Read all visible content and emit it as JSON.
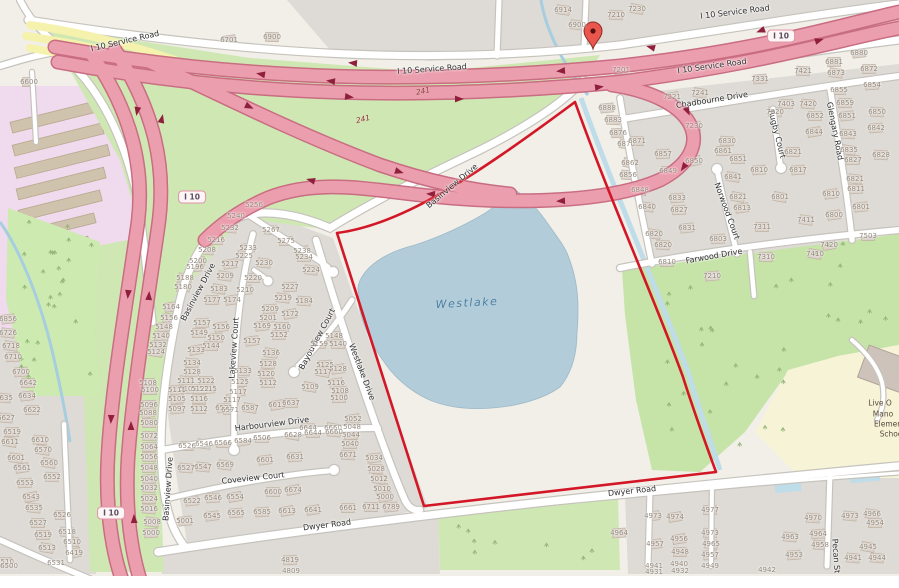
{
  "poi": {
    "lake_name": "Westlake",
    "school_lines": [
      "Live O",
      "Mano",
      "Elemen",
      "Schoo"
    ]
  },
  "marker": {
    "x": 593,
    "y": 33
  },
  "route_shields": [
    {
      "label": "I 10",
      "x": 192,
      "y": 197
    },
    {
      "label": "I 10",
      "x": 111,
      "y": 513
    },
    {
      "label": "I 10",
      "x": 781,
      "y": 36
    }
  ],
  "exit_numbers": [
    {
      "label": "241",
      "x": 423,
      "y": 91,
      "rot": -12
    },
    {
      "label": "241",
      "x": 363,
      "y": 119,
      "rot": -14
    }
  ],
  "street_labels": [
    {
      "t": "I 10 Service Road",
      "x": 125,
      "y": 41,
      "r": -13
    },
    {
      "t": "I 10 Service Road",
      "x": 432,
      "y": 69,
      "r": -4
    },
    {
      "t": "I 10 Service Road",
      "x": 735,
      "y": 12,
      "r": -7
    },
    {
      "t": "I 10 Service Road",
      "x": 712,
      "y": 66,
      "r": -8
    },
    {
      "t": "Basinview Drive",
      "x": 452,
      "y": 186,
      "r": -40
    },
    {
      "t": "Basinview Drive",
      "x": 198,
      "y": 292,
      "r": -62
    },
    {
      "t": "Basinview Drive",
      "x": 168,
      "y": 489,
      "r": -86
    },
    {
      "t": "Lakeview Court",
      "x": 234,
      "y": 348,
      "r": -86
    },
    {
      "t": "Bayouview Court",
      "x": 317,
      "y": 339,
      "r": -62
    },
    {
      "t": "Westlake Drive",
      "x": 362,
      "y": 372,
      "r": 69
    },
    {
      "t": "Harbourview Drive",
      "x": 272,
      "y": 424,
      "r": -7
    },
    {
      "t": "Coveview Court",
      "x": 253,
      "y": 478,
      "r": -6
    },
    {
      "t": "Dwyer Road",
      "x": 327,
      "y": 525,
      "r": -7
    },
    {
      "t": "Dwyer Road",
      "x": 632,
      "y": 491,
      "r": -6
    },
    {
      "t": "Chadbourne Drive",
      "x": 712,
      "y": 100,
      "r": -9
    },
    {
      "t": "Rugby Court",
      "x": 777,
      "y": 134,
      "r": 76
    },
    {
      "t": "Glengary Road",
      "x": 835,
      "y": 131,
      "r": 79
    },
    {
      "t": "Norwood Court",
      "x": 727,
      "y": 211,
      "r": 70
    },
    {
      "t": "Farwood Drive",
      "x": 714,
      "y": 256,
      "r": -10
    },
    {
      "t": "Pecan St",
      "x": 836,
      "y": 556,
      "r": 86
    }
  ],
  "house_numbers": [
    [
      "6600",
      29,
      82
    ],
    [
      "6701",
      229,
      40
    ],
    [
      "6900",
      272,
      37
    ],
    [
      "6914",
      563,
      10
    ],
    [
      "6900",
      577,
      25
    ],
    [
      "7210",
      616,
      15
    ],
    [
      "7230",
      637,
      9
    ],
    [
      "7201",
      621,
      70
    ],
    [
      "7221",
      672,
      97
    ],
    [
      "7241",
      700,
      93
    ],
    [
      "7230",
      694,
      126
    ],
    [
      "7331",
      760,
      79
    ],
    [
      "7421",
      803,
      71
    ],
    [
      "7403",
      786,
      104
    ],
    [
      "7420",
      808,
      104
    ],
    [
      "7320",
      775,
      112
    ],
    [
      "6888",
      607,
      108
    ],
    [
      "6883",
      613,
      120
    ],
    [
      "6876",
      618,
      133
    ],
    [
      "6870",
      626,
      144
    ],
    [
      "6871",
      637,
      141
    ],
    [
      "6862",
      630,
      163
    ],
    [
      "6856",
      628,
      175
    ],
    [
      "6848",
      640,
      190
    ],
    [
      "6840",
      647,
      207
    ],
    [
      "6857",
      663,
      154
    ],
    [
      "6849",
      668,
      171
    ],
    [
      "6850",
      694,
      161
    ],
    [
      "6861",
      723,
      151
    ],
    [
      "6851",
      738,
      159
    ],
    [
      "6841",
      733,
      177
    ],
    [
      "6833",
      677,
      198
    ],
    [
      "6827",
      679,
      210
    ],
    [
      "6820",
      654,
      234
    ],
    [
      "6821",
      738,
      197
    ],
    [
      "6813",
      742,
      208
    ],
    [
      "6810",
      759,
      170
    ],
    [
      "6817",
      798,
      170
    ],
    [
      "6821",
      793,
      152
    ],
    [
      "6830",
      727,
      141
    ],
    [
      "6801",
      780,
      197
    ],
    [
      "6831",
      687,
      228
    ],
    [
      "6803",
      718,
      239
    ],
    [
      "6820",
      663,
      245
    ],
    [
      "6810",
      667,
      262
    ],
    [
      "7311",
      762,
      227
    ],
    [
      "7411",
      806,
      220
    ],
    [
      "6800",
      834,
      215
    ],
    [
      "6810",
      831,
      194
    ],
    [
      "7310",
      766,
      257
    ],
    [
      "7210",
      712,
      276
    ],
    [
      "7410",
      815,
      254
    ],
    [
      "7420",
      829,
      245
    ],
    [
      "7503",
      868,
      236
    ],
    [
      "6880",
      859,
      53
    ],
    [
      "6881",
      834,
      62
    ],
    [
      "6872",
      869,
      69
    ],
    [
      "6873",
      836,
      73
    ],
    [
      "6854",
      872,
      85
    ],
    [
      "6855",
      839,
      90
    ],
    [
      "6859",
      845,
      103
    ],
    [
      "6850",
      877,
      112
    ],
    [
      "6851",
      847,
      116
    ],
    [
      "6852",
      815,
      116
    ],
    [
      "6844",
      814,
      132
    ],
    [
      "6843",
      848,
      134
    ],
    [
      "6842",
      876,
      128
    ],
    [
      "6835",
      849,
      150
    ],
    [
      "6828",
      881,
      155
    ],
    [
      "6827",
      853,
      160
    ],
    [
      "6821",
      855,
      179
    ],
    [
      "6811",
      856,
      189
    ],
    [
      "6801",
      861,
      207
    ],
    [
      "5256",
      254,
      205
    ],
    [
      "5240",
      236,
      216
    ],
    [
      "5232",
      230,
      228
    ],
    [
      "5267",
      271,
      230
    ],
    [
      "5275",
      286,
      241
    ],
    [
      "5216",
      216,
      240
    ],
    [
      "5208",
      207,
      250
    ],
    [
      "5233",
      248,
      248
    ],
    [
      "5225",
      244,
      256
    ],
    [
      "5238",
      302,
      251
    ],
    [
      "5234",
      304,
      257
    ],
    [
      "5200",
      198,
      261
    ],
    [
      "5196",
      195,
      267
    ],
    [
      "5217",
      230,
      264
    ],
    [
      "5230",
      264,
      263
    ],
    [
      "5224",
      311,
      270
    ],
    [
      "5188",
      185,
      278
    ],
    [
      "5209",
      225,
      276
    ],
    [
      "5220",
      253,
      278
    ],
    [
      "5180",
      183,
      287
    ],
    [
      "5183",
      219,
      289
    ],
    [
      "5210",
      245,
      290
    ],
    [
      "5227",
      290,
      287
    ],
    [
      "5177",
      212,
      300
    ],
    [
      "5174",
      232,
      300
    ],
    [
      "5219",
      283,
      298
    ],
    [
      "5184",
      304,
      301
    ],
    [
      "5164",
      171,
      307
    ],
    [
      "5209",
      270,
      309
    ],
    [
      "5172",
      290,
      314
    ],
    [
      "5156",
      169,
      318
    ],
    [
      "5201",
      268,
      318
    ],
    [
      "5157",
      202,
      323
    ],
    [
      "5169",
      262,
      326
    ],
    [
      "5160",
      282,
      327
    ],
    [
      "5148",
      164,
      327
    ],
    [
      "5156",
      221,
      327
    ],
    [
      "5149",
      199,
      333
    ],
    [
      "5152",
      279,
      335
    ],
    [
      "5140",
      161,
      336
    ],
    [
      "5150",
      216,
      338
    ],
    [
      "5157",
      252,
      341
    ],
    [
      "5144",
      211,
      346
    ],
    [
      "5136",
      271,
      353
    ],
    [
      "5132",
      158,
      345
    ],
    [
      "5133",
      196,
      350
    ],
    [
      "5124",
      156,
      352
    ],
    [
      "5134",
      192,
      363
    ],
    [
      "5128",
      192,
      372
    ],
    [
      "5128",
      268,
      364
    ],
    [
      "5133",
      243,
      371
    ],
    [
      "5120",
      266,
      374
    ],
    [
      "5122",
      206,
      381
    ],
    [
      "5125",
      240,
      382
    ],
    [
      "5111",
      186,
      381
    ],
    [
      "5105",
      188,
      389
    ],
    [
      "5115",
      208,
      389
    ],
    [
      "5112",
      268,
      383
    ],
    [
      "5117",
      238,
      392
    ],
    [
      "5148",
      334,
      336
    ],
    [
      "5159",
      319,
      344
    ],
    [
      "5140",
      338,
      344
    ],
    [
      "5125",
      325,
      365
    ],
    [
      "5128",
      338,
      369
    ],
    [
      "5117",
      323,
      372
    ],
    [
      "5116",
      336,
      383
    ],
    [
      "5109",
      310,
      387
    ],
    [
      "5108",
      340,
      391
    ],
    [
      "5100",
      339,
      398
    ],
    [
      "5108",
      148,
      383
    ],
    [
      "5100",
      150,
      390
    ],
    [
      "5111",
      177,
      390
    ],
    [
      "5122",
      200,
      389
    ],
    [
      "5105",
      177,
      399
    ],
    [
      "5116",
      199,
      399
    ],
    [
      "5117",
      232,
      400
    ],
    [
      "5096",
      149,
      405
    ],
    [
      "5097",
      177,
      409
    ],
    [
      "5112",
      199,
      409
    ],
    [
      "5088",
      148,
      413
    ],
    [
      "6521",
      224,
      408
    ],
    [
      "5080",
      149,
      423
    ],
    [
      "5072",
      149,
      436
    ],
    [
      "5064",
      149,
      447
    ],
    [
      "5056",
      149,
      457
    ],
    [
      "5048",
      149,
      468
    ],
    [
      "5040",
      149,
      479
    ],
    [
      "5032",
      149,
      488
    ],
    [
      "5024",
      149,
      499
    ],
    [
      "5016",
      149,
      509
    ],
    [
      "5008",
      152,
      522
    ],
    [
      "5000",
      151,
      533
    ],
    [
      "6856",
      8,
      319
    ],
    [
      "6726",
      8,
      333
    ],
    [
      "6718",
      11,
      346
    ],
    [
      "6710",
      13,
      357
    ],
    [
      "6700",
      21,
      372
    ],
    [
      "6642",
      28,
      383
    ],
    [
      "6634",
      27,
      396
    ],
    [
      "6635",
      4,
      398
    ],
    [
      "6622",
      32,
      410
    ],
    [
      "6627",
      6,
      418
    ],
    [
      "6519",
      12,
      432
    ],
    [
      "6610",
      40,
      440
    ],
    [
      "6611",
      10,
      442
    ],
    [
      "6570",
      43,
      450
    ],
    [
      "6601",
      16,
      458
    ],
    [
      "6560",
      49,
      463
    ],
    [
      "6561",
      22,
      468
    ],
    [
      "6552",
      52,
      477
    ],
    [
      "6553",
      25,
      483
    ],
    [
      "6543",
      31,
      497
    ],
    [
      "6535",
      34,
      508
    ],
    [
      "6526",
      62,
      515
    ],
    [
      "6527",
      38,
      523
    ],
    [
      "6519",
      43,
      535
    ],
    [
      "6518",
      67,
      532
    ],
    [
      "6510",
      72,
      542
    ],
    [
      "6513",
      47,
      548
    ],
    [
      "6419",
      74,
      553
    ],
    [
      "6510",
      5,
      562
    ],
    [
      "6531",
      56,
      563
    ],
    [
      "6500",
      9,
      566
    ],
    [
      "5052",
      353,
      419
    ],
    [
      "5048",
      352,
      427
    ],
    [
      "5044",
      351,
      435
    ],
    [
      "5040",
      350,
      444
    ],
    [
      "6644",
      308,
      428
    ],
    [
      "6660",
      333,
      428
    ],
    [
      "6671",
      348,
      455
    ],
    [
      "5034",
      374,
      458
    ],
    [
      "5028",
      376,
      469
    ],
    [
      "5012",
      379,
      479
    ],
    [
      "5010",
      382,
      489
    ],
    [
      "5000",
      385,
      497
    ],
    [
      "6571",
      230,
      410
    ],
    [
      "6587",
      250,
      408
    ],
    [
      "6613",
      277,
      405
    ],
    [
      "6637",
      291,
      403
    ],
    [
      "6628",
      293,
      435
    ],
    [
      "6644",
      313,
      433
    ],
    [
      "6660",
      334,
      432
    ],
    [
      "6584",
      243,
      441
    ],
    [
      "6566",
      223,
      443
    ],
    [
      "6546",
      204,
      444
    ],
    [
      "6526",
      187,
      446
    ],
    [
      "6506",
      262,
      438
    ],
    [
      "6569",
      225,
      465
    ],
    [
      "6547",
      203,
      467
    ],
    [
      "6527",
      186,
      468
    ],
    [
      "6601",
      265,
      460
    ],
    [
      "6631",
      295,
      457
    ],
    [
      "6522",
      192,
      501
    ],
    [
      "6546",
      213,
      498
    ],
    [
      "6554",
      235,
      497
    ],
    [
      "6600",
      273,
      492
    ],
    [
      "6674",
      293,
      490
    ],
    [
      "5001",
      185,
      521
    ],
    [
      "6545",
      212,
      516
    ],
    [
      "6565",
      236,
      513
    ],
    [
      "6585",
      262,
      512
    ],
    [
      "6613",
      287,
      511
    ],
    [
      "6641",
      313,
      510
    ],
    [
      "6661",
      348,
      508
    ],
    [
      "6711",
      371,
      507
    ],
    [
      "6789",
      391,
      507
    ],
    [
      "4819",
      290,
      560
    ],
    [
      "4809",
      291,
      571
    ],
    [
      "4964",
      619,
      533
    ],
    [
      "4973",
      653,
      516
    ],
    [
      "4974",
      675,
      517
    ],
    [
      "4977",
      710,
      510
    ],
    [
      "4957",
      655,
      544
    ],
    [
      "4956",
      679,
      539
    ],
    [
      "4948",
      680,
      552
    ],
    [
      "4941",
      654,
      566
    ],
    [
      "4940",
      679,
      564
    ],
    [
      "4931",
      654,
      572
    ],
    [
      "4932",
      680,
      571
    ],
    [
      "4973",
      710,
      533
    ],
    [
      "4965",
      711,
      544
    ],
    [
      "4957",
      710,
      555
    ],
    [
      "4949",
      710,
      566
    ],
    [
      "4942",
      767,
      570
    ],
    [
      "4963",
      790,
      537
    ],
    [
      "4964",
      818,
      534
    ],
    [
      "4958",
      820,
      545
    ],
    [
      "4953",
      794,
      555
    ],
    [
      "4970",
      813,
      518
    ],
    [
      "4973",
      850,
      516
    ],
    [
      "4966",
      872,
      514
    ],
    [
      "4954",
      875,
      523
    ],
    [
      "4945",
      868,
      547
    ],
    [
      "4944",
      877,
      558
    ],
    [
      "4941",
      853,
      558
    ]
  ]
}
